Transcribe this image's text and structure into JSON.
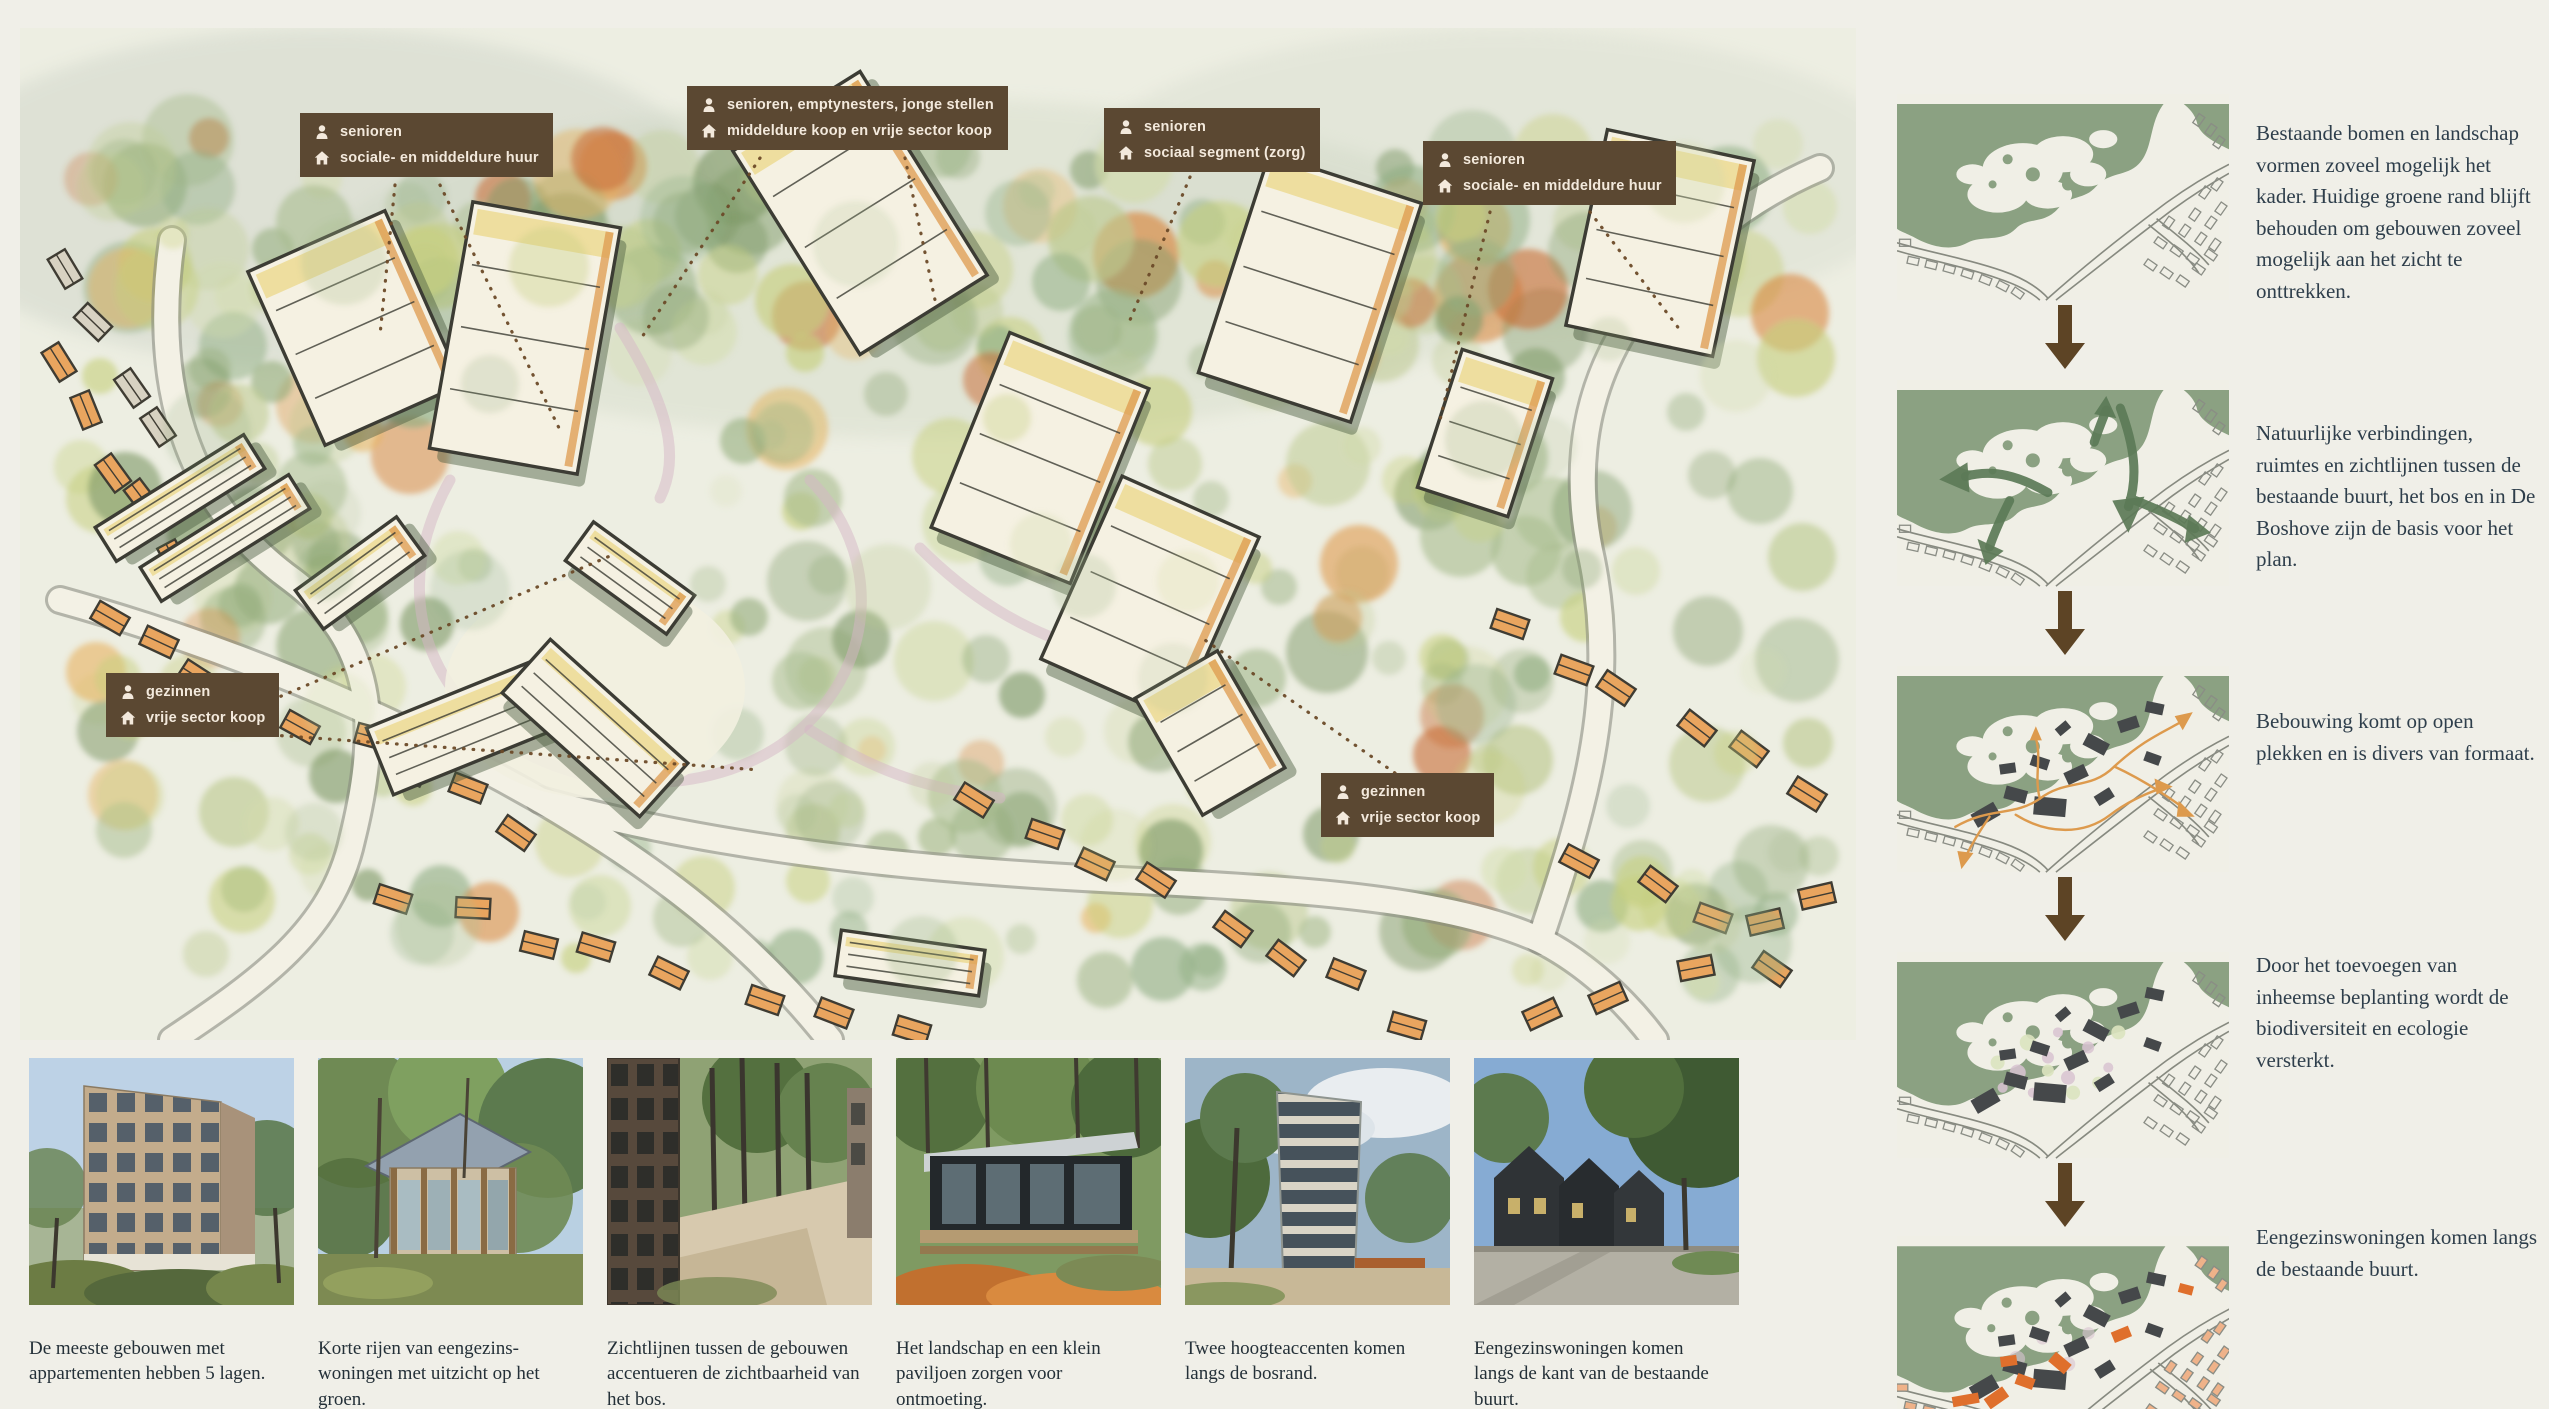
{
  "map": {
    "labels": [
      {
        "line1": "senioren",
        "line2": "sociale- en middeldure huur"
      },
      {
        "line1": "senioren, emptynesters, jonge stellen",
        "line2": "middeldure koop en vrije sector koop"
      },
      {
        "line1": "senioren",
        "line2": "sociaal segment (zorg)"
      },
      {
        "line1": "senioren",
        "line2": "sociale- en middeldure huur"
      },
      {
        "line1": "gezinnen",
        "line2": "vrije sector koop"
      },
      {
        "line1": "gezinnen",
        "line2": "vrije sector koop"
      }
    ]
  },
  "photos": {
    "captions": [
      "De meeste gebouwen met appartementen hebben 5 lagen.",
      "Korte rijen van eengezins-woningen met uitzicht op het groen.",
      "Zichtlijnen tussen de gebouwen accentueren de zichtbaarheid van het bos.",
      "Het landschap en een klein paviljoen zorgen voor ontmoeting.",
      "Twee hoogteaccenten komen langs de bosrand.",
      "Eengezinswoningen komen langs de kant van de bestaande buurt."
    ]
  },
  "steps": {
    "texts": [
      "Bestaande bomen en landschap vormen zoveel mogelijk het kader. Huidige groene rand blijft behouden om gebouwen zoveel mogelijk aan het zicht te onttrekken.",
      "Natuurlijke verbindingen, ruimtes en zichtlijnen tussen de bestaande buurt, het bos en in De Boshove zijn de basis voor het plan.",
      "Bebouwing komt op open plekken en is divers van formaat.",
      "Door het toevoegen van inheemse beplanting wordt de biodiversiteit en ecologie versterkt.",
      "Eengezinswoningen komen langs de bestaande buurt."
    ]
  },
  "colors": {
    "label_bg": "#5b4832",
    "label_text": "#f3e9dc",
    "step_text": "#2e3e4b",
    "diagram_green": "#8ba182",
    "connection_green": "#5c7a57",
    "accent_orange": "#dd9a4d",
    "building_dark": "#45484a",
    "new_orange": "#df6f2c",
    "arrow_brown": "#5d4425"
  }
}
